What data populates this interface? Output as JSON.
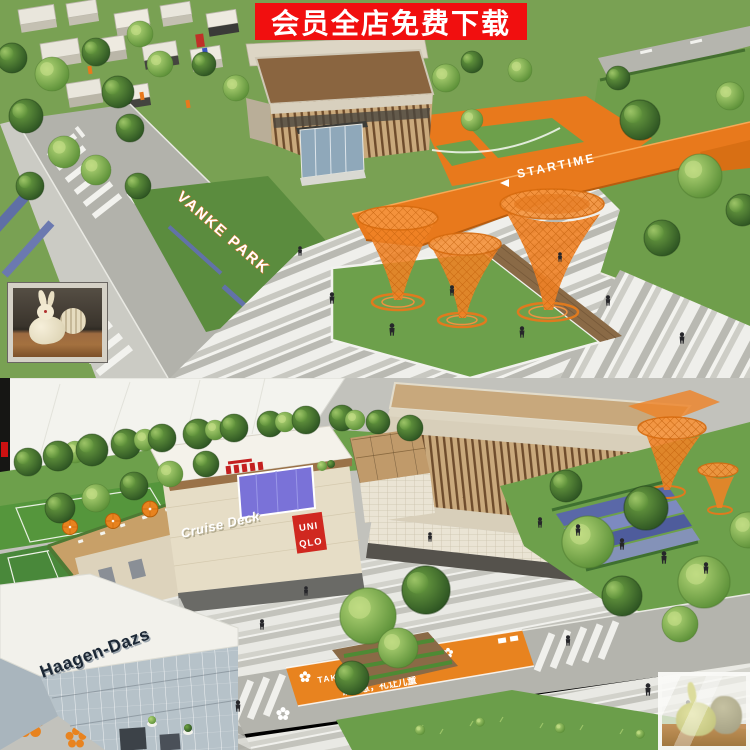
{
  "banner": {
    "label": "会员全店免费下载"
  },
  "top_render": {
    "park_sign": "VANKE PARK",
    "deck_sign": "STARTIME"
  },
  "bottom_render": {
    "haagen_dazs_sign": "Haagen-Dazs",
    "cruise_deck_sign": "Cruise Deck",
    "uniqlo_line1": "UNI",
    "uniqlo_line2": "QLO",
    "crosswalk_en": "TAKE CARE OF CHILD",
    "crosswalk_zh": "请注意，礼让儿童"
  },
  "colors": {
    "banner_red": "#f10f0f",
    "accent_orange": "#e8831f",
    "lawn_green": "#6da04b",
    "uniqlo_red": "#d02820",
    "glass_blue": "#7a72d8",
    "haagen_navy": "#1c2835"
  }
}
